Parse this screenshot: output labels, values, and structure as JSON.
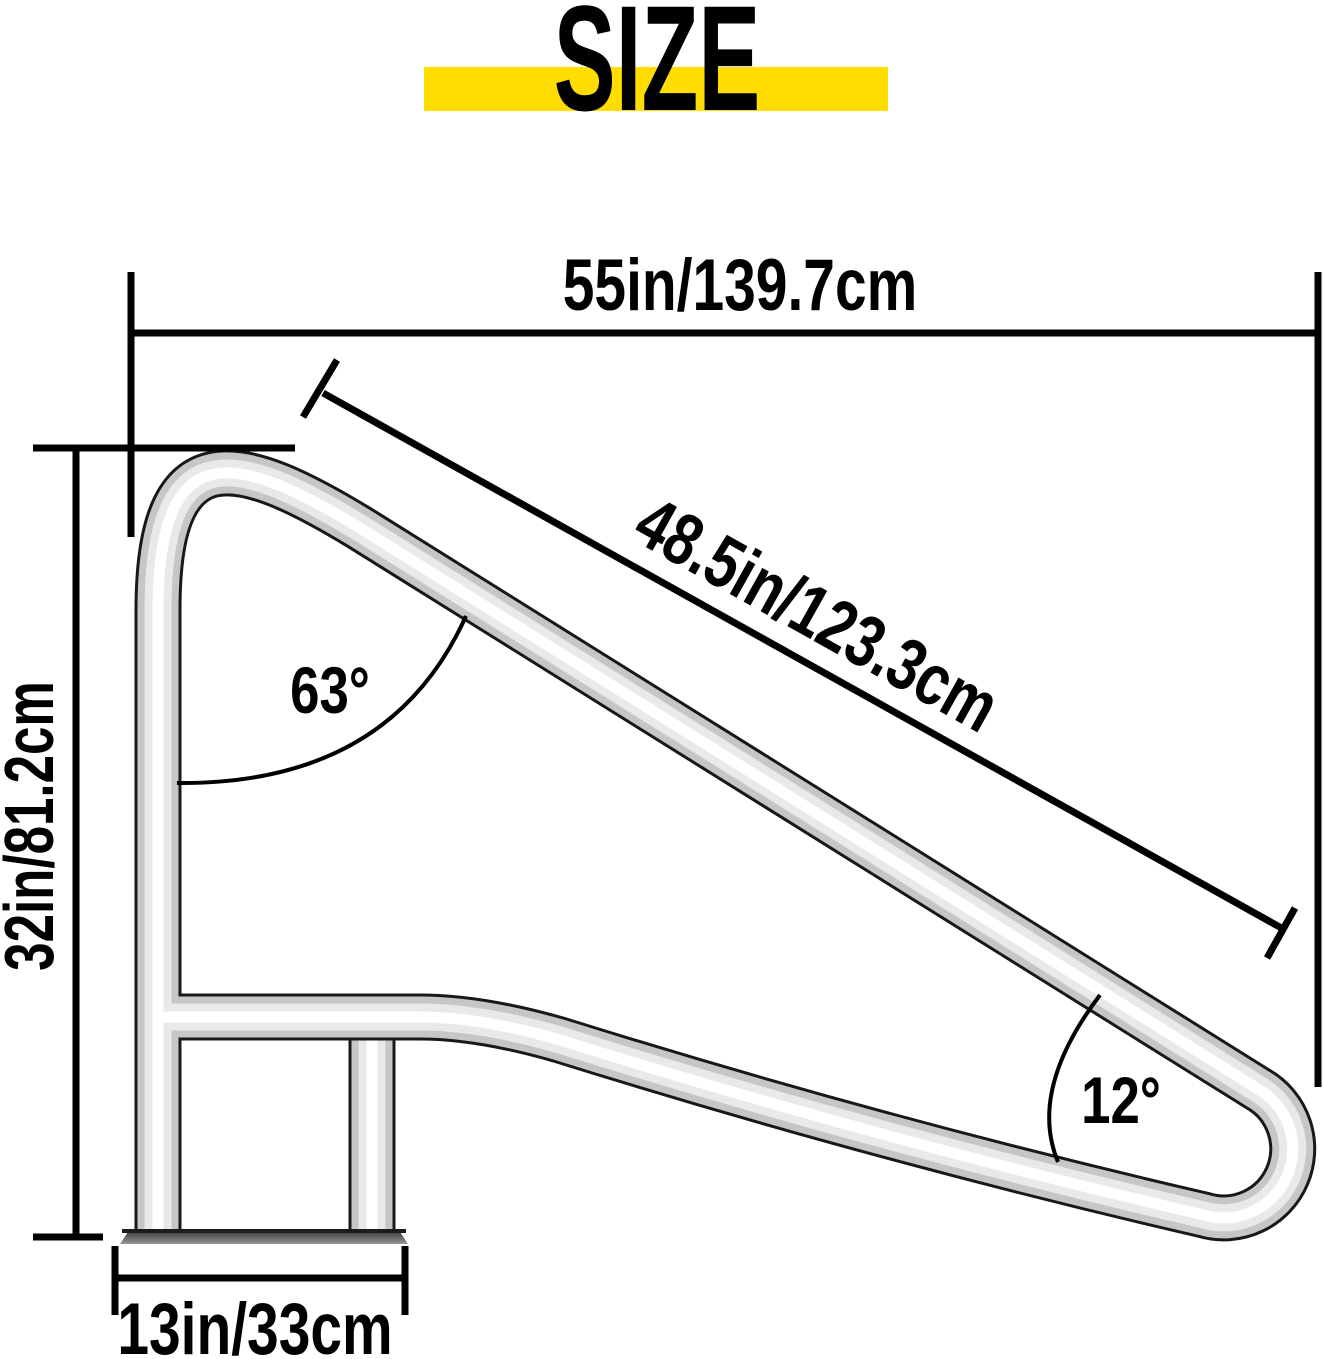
{
  "title": "SIZE",
  "dimensions": {
    "overall_width": "55in/139.7cm",
    "rail_length": "48.5in/123.3cm",
    "overall_height": "32in/81.2cm",
    "base_width": "13in/33cm"
  },
  "angles": {
    "top_angle": "63°",
    "bottom_angle": "12°"
  },
  "colors": {
    "highlight": "#FFDD00",
    "line": "#000000",
    "rail_outline": "#181818",
    "rail_body": "#c6c6c6",
    "rail_light": "#e9e9e9",
    "rail_specular": "#ffffff",
    "plate_dark": "#2e2e2e",
    "plate_light": "#979797"
  }
}
